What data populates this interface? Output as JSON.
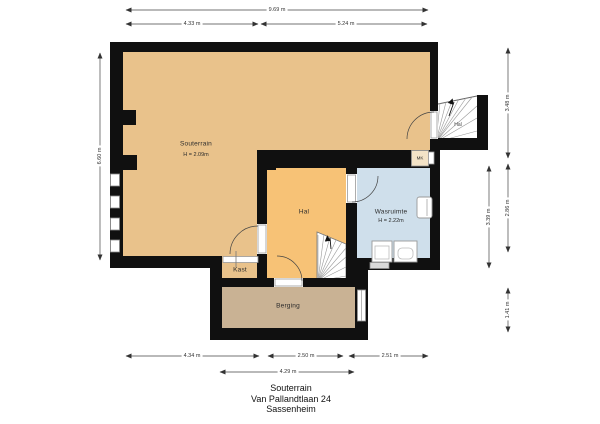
{
  "title_block": {
    "line1": "Souterrain",
    "line2": "Van Pallandtlaan 24",
    "line3": "Sassenheim"
  },
  "rooms": {
    "souterrain": {
      "label": "Souterrain",
      "height": "H = 2.09m"
    },
    "hal": {
      "label": "Hal"
    },
    "wasruimte": {
      "label": "Wasruimte",
      "height": "H = 2.22m"
    },
    "kast": {
      "label": "Kast"
    },
    "berging": {
      "label": "Berging"
    },
    "meterkast": {
      "label": "MK"
    },
    "stair_hal": {
      "label": "Hal"
    }
  },
  "dimensions": {
    "top_total": "9.69 m",
    "top_left": "4.33 m",
    "top_right": "5.24 m",
    "left_total": "6.60 m",
    "right_upper": "3.48 m",
    "right_middle_outer": "2.86 m",
    "right_middle_inner": "3.39 m",
    "right_lower": "1.41 m",
    "bottom_left": "4.34 m",
    "bottom_middle": "2.50 m",
    "bottom_right": "2.51 m",
    "bottom_second_row": "4.29 m"
  },
  "colors": {
    "souterrain": "#e9c28b",
    "hal": "#f7c276",
    "kast": "#e9c28b",
    "berging": "#c9b294",
    "wasruimte": "#cfdfeb",
    "wall": "#101010"
  }
}
